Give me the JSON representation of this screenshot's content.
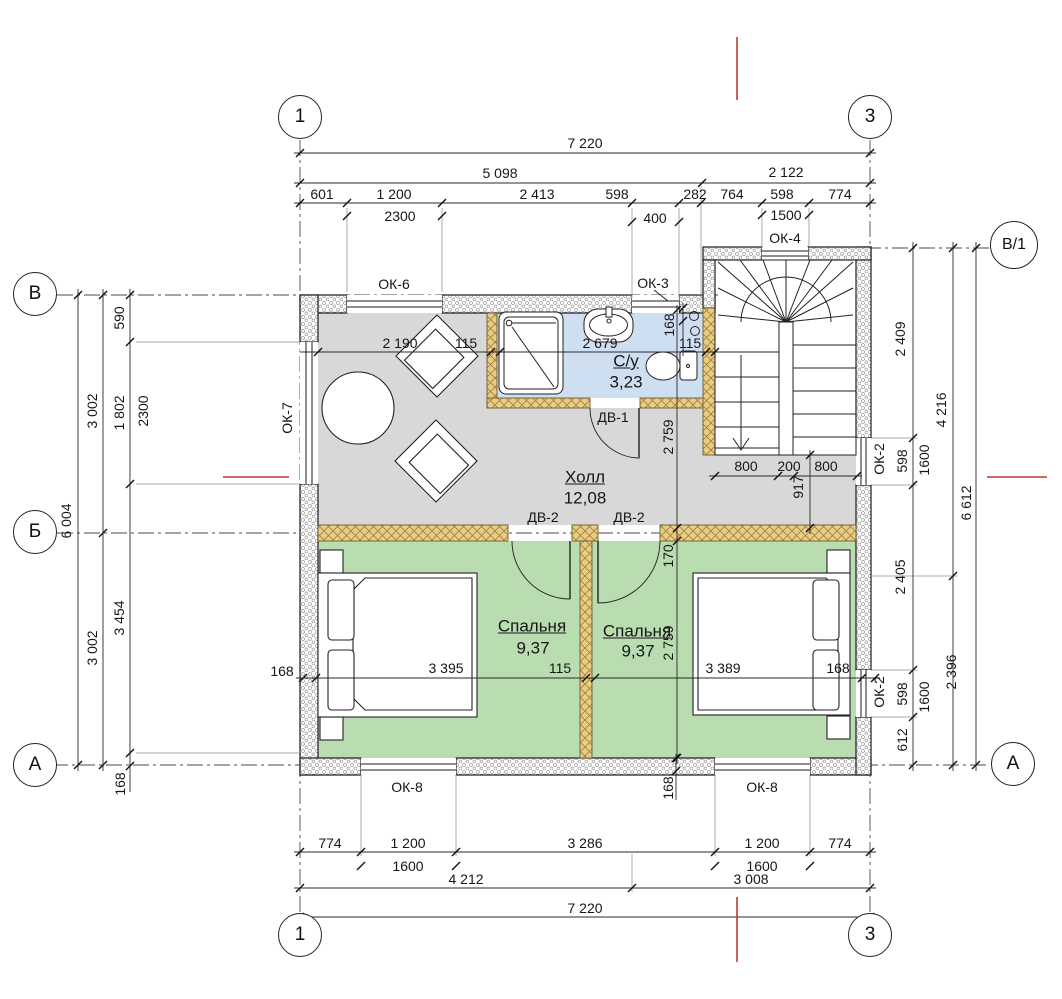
{
  "meta": {
    "type": "floor-plan",
    "language": "ru",
    "units": "mm"
  },
  "rooms": [
    {
      "name": "Холл",
      "area": "12,08"
    },
    {
      "name": "С/у",
      "area": "3,23"
    },
    {
      "name": "Спальня",
      "area": "9,37"
    },
    {
      "name": "Спальня",
      "area": "9,37"
    }
  ],
  "windows": [
    "ОК-2",
    "ОК-3",
    "ОК-4",
    "ОК-6",
    "ОК-7",
    "ОК-8"
  ],
  "doors": [
    "ДВ-1",
    "ДВ-2"
  ],
  "colors": {
    "hall": "#d8d8d8",
    "bath": "#cfdff2",
    "bedroom": "#b9dcb1",
    "partition": "#e7cd85",
    "partition_hatch": "#a5803a",
    "red_mark": "#c0392b"
  },
  "axes": {
    "columns": [
      "1",
      "3"
    ],
    "rows": [
      "В",
      "Б",
      "А",
      "В/1"
    ]
  },
  "axis_circles": [
    {
      "n": "axis-col-1-top",
      "t": "1",
      "x": 300,
      "y": 117,
      "d": 44
    },
    {
      "n": "axis-col-3-top",
      "t": "3",
      "x": 870,
      "y": 117,
      "d": 44
    },
    {
      "n": "axis-col-1-bottom",
      "t": "1",
      "x": 300,
      "y": 935,
      "d": 44
    },
    {
      "n": "axis-col-3-bottom",
      "t": "3",
      "x": 870,
      "y": 935,
      "d": 44
    },
    {
      "n": "axis-row-v",
      "t": "В",
      "x": 35,
      "y": 294,
      "d": 44
    },
    {
      "n": "axis-row-b",
      "t": "Б",
      "x": 35,
      "y": 532,
      "d": 44
    },
    {
      "n": "axis-row-a-left",
      "t": "А",
      "x": 35,
      "y": 765,
      "d": 44
    },
    {
      "n": "axis-row-v1",
      "t": "В/1",
      "x": 1014,
      "y": 245,
      "d": 48,
      "size": 16
    },
    {
      "n": "axis-row-a-right",
      "t": "А",
      "x": 1013,
      "y": 764,
      "d": 44
    }
  ],
  "labels": [
    {
      "n": "dim-top-7220",
      "text": "7 220",
      "x": 585,
      "y": 143
    },
    {
      "n": "dim-top-5098",
      "text": "5 098",
      "x": 500,
      "y": 173
    },
    {
      "n": "dim-top-2122",
      "text": "2 122",
      "x": 786,
      "y": 172
    },
    {
      "n": "dim-top-601",
      "text": "601",
      "x": 322,
      "y": 194
    },
    {
      "n": "dim-top-1200",
      "text": "1 200",
      "x": 394,
      "y": 194
    },
    {
      "n": "dim-top-2413",
      "text": "2 413",
      "x": 537,
      "y": 194
    },
    {
      "n": "dim-top-598a",
      "text": "598",
      "x": 617,
      "y": 194
    },
    {
      "n": "dim-top-282",
      "text": "282",
      "x": 695,
      "y": 194
    },
    {
      "n": "dim-top-764",
      "text": "764",
      "x": 732,
      "y": 194
    },
    {
      "n": "dim-top-598b",
      "text": "598",
      "x": 782,
      "y": 194
    },
    {
      "n": "dim-top-774",
      "text": "774",
      "x": 840,
      "y": 194
    },
    {
      "n": "dim-top-2300",
      "text": "2300",
      "x": 400,
      "y": 216
    },
    {
      "n": "dim-top-400",
      "text": "400",
      "x": 655,
      "y": 218
    },
    {
      "n": "dim-top-1500",
      "text": "1500",
      "x": 786,
      "y": 215
    },
    {
      "n": "dim-bottom-774a",
      "text": "774",
      "x": 330,
      "y": 843
    },
    {
      "n": "dim-bottom-1200a",
      "text": "1 200",
      "x": 408,
      "y": 843
    },
    {
      "n": "dim-bottom-3286",
      "text": "3 286",
      "x": 585,
      "y": 843
    },
    {
      "n": "dim-bottom-1200b",
      "text": "1 200",
      "x": 762,
      "y": 843
    },
    {
      "n": "dim-bottom-774b",
      "text": "774",
      "x": 840,
      "y": 843
    },
    {
      "n": "dim-bottom-1600a",
      "text": "1600",
      "x": 408,
      "y": 866
    },
    {
      "n": "dim-bottom-1600b",
      "text": "1600",
      "x": 762,
      "y": 866
    },
    {
      "n": "dim-bottom-4212",
      "text": "4 212",
      "x": 466,
      "y": 879
    },
    {
      "n": "dim-bottom-3008",
      "text": "3 008",
      "x": 751,
      "y": 879
    },
    {
      "n": "dim-bottom-7220",
      "text": "7 220",
      "x": 585,
      "y": 908
    },
    {
      "n": "dim-left-590",
      "text": "590",
      "x": 119,
      "y": 318,
      "rot": -90
    },
    {
      "n": "dim-left-1802",
      "text": "1 802",
      "x": 119,
      "y": 413,
      "rot": -90
    },
    {
      "n": "dim-left-2300",
      "text": "2300",
      "x": 143,
      "y": 411,
      "rot": -90
    },
    {
      "n": "dim-left-3002a",
      "text": "3 002",
      "x": 92,
      "y": 411,
      "rot": -90
    },
    {
      "n": "dim-left-6004",
      "text": "6 004",
      "x": 66,
      "y": 521,
      "rot": -90
    },
    {
      "n": "dim-left-3454",
      "text": "3 454",
      "x": 119,
      "y": 618,
      "rot": -90
    },
    {
      "n": "dim-left-3002b",
      "text": "3 002",
      "x": 92,
      "y": 648,
      "rot": -90
    },
    {
      "n": "dim-left-168",
      "text": "168",
      "x": 120,
      "y": 784,
      "rot": -90
    },
    {
      "n": "dim-right-2409",
      "text": "2 409",
      "x": 900,
      "y": 339,
      "rot": -90
    },
    {
      "n": "dim-right-598a",
      "text": "598",
      "x": 902,
      "y": 461,
      "rot": -90
    },
    {
      "n": "dim-right-1600a",
      "text": "1600",
      "x": 924,
      "y": 460,
      "rot": -90
    },
    {
      "n": "dim-right-2405",
      "text": "2 405",
      "x": 900,
      "y": 577,
      "rot": -90
    },
    {
      "n": "dim-right-598b",
      "text": "598",
      "x": 902,
      "y": 694,
      "rot": -90
    },
    {
      "n": "dim-right-1600b",
      "text": "1600",
      "x": 924,
      "y": 697,
      "rot": -90
    },
    {
      "n": "dim-right-612",
      "text": "612",
      "x": 902,
      "y": 740,
      "rot": -90
    },
    {
      "n": "dim-right-4216",
      "text": "4 216",
      "x": 941,
      "y": 410,
      "rot": -90
    },
    {
      "n": "dim-right-2396",
      "text": "2 396",
      "x": 951,
      "y": 672,
      "rot": -90
    },
    {
      "n": "dim-right-6612",
      "text": "6 612",
      "x": 966,
      "y": 503,
      "rot": -90
    },
    {
      "n": "window-tag-ok2-stair",
      "text": "ОК-2",
      "x": 879,
      "y": 459,
      "rot": -90
    },
    {
      "n": "window-tag-ok2-bedroom",
      "text": "ОК-2",
      "x": 879,
      "y": 692,
      "rot": -90
    },
    {
      "n": "window-tag-ok6",
      "text": "ОК-6",
      "x": 394,
      "y": 284
    },
    {
      "n": "window-tag-ok3",
      "text": "ОК-3",
      "x": 653,
      "y": 283
    },
    {
      "n": "window-tag-ok4",
      "text": "ОК-4",
      "x": 785,
      "y": 238
    },
    {
      "n": "window-tag-ok7",
      "text": "ОК-7",
      "x": 287,
      "y": 418,
      "rot": -90
    },
    {
      "n": "window-tag-ok8-left",
      "text": "ОК-8",
      "x": 407,
      "y": 787
    },
    {
      "n": "window-tag-ok8-right",
      "text": "ОК-8",
      "x": 762,
      "y": 787
    },
    {
      "n": "door-tag-dv1",
      "text": "ДВ-1",
      "x": 613,
      "y": 417
    },
    {
      "n": "door-tag-dv2-left",
      "text": "ДВ-2",
      "x": 543,
      "y": 517
    },
    {
      "n": "door-tag-dv2-right",
      "text": "ДВ-2",
      "x": 629,
      "y": 517
    },
    {
      "n": "dim-int-2190",
      "text": "2 190",
      "x": 400,
      "y": 343
    },
    {
      "n": "dim-int-115a",
      "text": "115",
      "x": 466,
      "y": 343
    },
    {
      "n": "dim-int-2679",
      "text": "2 679",
      "x": 600,
      "y": 343
    },
    {
      "n": "dim-int-115b",
      "text": "115",
      "x": 690,
      "y": 343
    },
    {
      "n": "dim-int-168a",
      "text": "168",
      "x": 669,
      "y": 325,
      "rot": -90
    },
    {
      "n": "dim-int-2759-hall",
      "text": "2 759",
      "x": 668,
      "y": 437,
      "rot": -90
    },
    {
      "n": "dim-int-170",
      "text": "170",
      "x": 668,
      "y": 556,
      "rot": -90
    },
    {
      "n": "dim-int-2759-bedroom",
      "text": "2 759",
      "x": 668,
      "y": 643,
      "rot": -90
    },
    {
      "n": "dim-int-800a",
      "text": "800",
      "x": 746,
      "y": 466
    },
    {
      "n": "dim-int-200",
      "text": "200",
      "x": 789,
      "y": 466
    },
    {
      "n": "dim-int-800b",
      "text": "800",
      "x": 826,
      "y": 466
    },
    {
      "n": "dim-int-917",
      "text": "917",
      "x": 798,
      "y": 487,
      "rot": -90
    },
    {
      "n": "dim-int-168-left",
      "text": "168",
      "x": 282,
      "y": 671
    },
    {
      "n": "dim-int-3395",
      "text": "3 395",
      "x": 446,
      "y": 668
    },
    {
      "n": "dim-int-115c",
      "text": "115",
      "x": 560,
      "y": 668
    },
    {
      "n": "dim-int-3389",
      "text": "3 389",
      "x": 723,
      "y": 668
    },
    {
      "n": "dim-int-168-right",
      "text": "168",
      "x": 838,
      "y": 668
    },
    {
      "n": "dim-int-168-bottom",
      "text": "168",
      "x": 668,
      "y": 788,
      "rot": -90
    },
    {
      "n": "room-name-hall",
      "text": "Холл",
      "x": 585,
      "y": 477,
      "size": 17,
      "u": true
    },
    {
      "n": "room-area-hall",
      "text": "12,08",
      "x": 585,
      "y": 498,
      "size": 17
    },
    {
      "n": "room-name-bath",
      "text": "С/у",
      "x": 626,
      "y": 361,
      "size": 17,
      "u": true
    },
    {
      "n": "room-area-bath",
      "text": "3,23",
      "x": 626,
      "y": 382,
      "size": 17
    },
    {
      "n": "room-name-bedroom-1",
      "text": "Спальня",
      "x": 532,
      "y": 626,
      "size": 17,
      "u": true
    },
    {
      "n": "room-area-bedroom-1",
      "text": "9,37",
      "x": 533,
      "y": 648,
      "size": 17
    },
    {
      "n": "room-name-bedroom-2",
      "text": "Спальня",
      "x": 637,
      "y": 631,
      "size": 17,
      "u": true
    },
    {
      "n": "room-area-bedroom-2",
      "text": "9,37",
      "x": 638,
      "y": 651,
      "size": 17
    }
  ],
  "dim_chains": [
    {
      "o": "h",
      "p": 153,
      "a": 294,
      "b": 876,
      "t": [
        300,
        870
      ]
    },
    {
      "o": "h",
      "p": 183,
      "a": 294,
      "b": 876,
      "t": [
        300,
        702,
        870
      ]
    },
    {
      "o": "h",
      "p": 203,
      "a": 294,
      "b": 876,
      "t": [
        300,
        347,
        442,
        632,
        679,
        701,
        762,
        809,
        870
      ]
    },
    {
      "o": "h",
      "p": 216,
      "a": 347,
      "b": 442,
      "t": [
        347,
        442
      ],
      "noline": true
    },
    {
      "o": "h",
      "p": 222,
      "a": 632,
      "b": 679,
      "t": [
        632,
        679
      ],
      "noline": true
    },
    {
      "o": "h",
      "p": 215,
      "a": 762,
      "b": 809,
      "t": [
        762,
        809
      ],
      "noline": true
    },
    {
      "o": "h",
      "p": 852,
      "a": 294,
      "b": 876,
      "t": [
        300,
        361,
        456,
        715,
        810,
        870
      ]
    },
    {
      "o": "h",
      "p": 866,
      "a": 361,
      "b": 456,
      "t": [
        361,
        456
      ],
      "noline": true
    },
    {
      "o": "h",
      "p": 866,
      "a": 715,
      "b": 810,
      "t": [
        715,
        810
      ],
      "noline": true
    },
    {
      "o": "h",
      "p": 888,
      "a": 294,
      "b": 876,
      "t": [
        300,
        632,
        870
      ]
    },
    {
      "o": "h",
      "p": 917,
      "a": 294,
      "b": 876,
      "t": [
        300,
        870
      ]
    },
    {
      "o": "h",
      "p": 352,
      "a": 300,
      "b": 722,
      "t": [
        318,
        491,
        500,
        706,
        715
      ]
    },
    {
      "o": "h",
      "p": 678,
      "a": 296,
      "b": 880,
      "t": [
        303,
        316,
        586,
        595,
        862,
        875
      ]
    },
    {
      "o": "h",
      "p": 476,
      "a": 709,
      "b": 862,
      "t": [
        715,
        778,
        794,
        857
      ]
    },
    {
      "o": "v",
      "p": 78,
      "a": 289,
      "b": 771,
      "t": [
        295,
        765
      ]
    },
    {
      "o": "v",
      "p": 103,
      "a": 289,
      "b": 771,
      "t": [
        295,
        533,
        765
      ]
    },
    {
      "o": "v",
      "p": 130,
      "a": 289,
      "b": 792,
      "t": [
        295,
        342,
        484,
        753,
        766
      ]
    },
    {
      "o": "v",
      "p": 913,
      "a": 242,
      "b": 771,
      "t": [
        248,
        438,
        485,
        670,
        717,
        765
      ]
    },
    {
      "o": "v",
      "p": 953,
      "a": 242,
      "b": 771,
      "t": [
        248,
        576,
        765
      ]
    },
    {
      "o": "v",
      "p": 976,
      "a": 242,
      "b": 771,
      "t": [
        248,
        765
      ]
    },
    {
      "o": "v",
      "p": 677,
      "a": 305,
      "b": 764,
      "t": [
        310,
        528,
        541,
        758
      ]
    },
    {
      "o": "v",
      "p": 810,
      "a": 450,
      "b": 534,
      "t": [
        455,
        528
      ]
    },
    {
      "o": "v",
      "p": 683,
      "a": 303,
      "b": 356,
      "t": [
        308,
        321
      ]
    },
    {
      "o": "v",
      "p": 676,
      "a": 754,
      "b": 800,
      "t": [
        758,
        771
      ]
    }
  ],
  "ext_lines": [
    {
      "o": "v",
      "p": 347,
      "a": 208,
      "b": 292
    },
    {
      "o": "v",
      "p": 442,
      "a": 208,
      "b": 292
    },
    {
      "o": "v",
      "p": 632,
      "a": 208,
      "b": 298
    },
    {
      "o": "v",
      "p": 679,
      "a": 208,
      "b": 298
    },
    {
      "o": "v",
      "p": 701,
      "a": 186,
      "b": 300
    },
    {
      "o": "v",
      "p": 762,
      "a": 208,
      "b": 246
    },
    {
      "o": "v",
      "p": 809,
      "a": 208,
      "b": 246
    },
    {
      "o": "v",
      "p": 361,
      "a": 775,
      "b": 856
    },
    {
      "o": "v",
      "p": 456,
      "a": 775,
      "b": 856
    },
    {
      "o": "v",
      "p": 715,
      "a": 775,
      "b": 856
    },
    {
      "o": "v",
      "p": 810,
      "a": 775,
      "b": 856
    },
    {
      "o": "v",
      "p": 632,
      "a": 854,
      "b": 892
    },
    {
      "o": "h",
      "p": 342,
      "a": 136,
      "b": 300
    },
    {
      "o": "h",
      "p": 484,
      "a": 136,
      "b": 300
    },
    {
      "o": "h",
      "p": 753,
      "a": 136,
      "b": 300
    },
    {
      "o": "h",
      "p": 438,
      "a": 872,
      "b": 917
    },
    {
      "o": "h",
      "p": 485,
      "a": 872,
      "b": 917
    },
    {
      "o": "h",
      "p": 670,
      "a": 872,
      "b": 917
    },
    {
      "o": "h",
      "p": 717,
      "a": 872,
      "b": 917
    },
    {
      "o": "h",
      "p": 576,
      "a": 872,
      "b": 957
    }
  ],
  "axis_lines": [
    {
      "o": "v",
      "p": 300,
      "a": 140,
      "b": 912
    },
    {
      "o": "v",
      "p": 870,
      "a": 140,
      "b": 912
    },
    {
      "o": "h",
      "p": 295,
      "a": 57,
      "b": 718
    },
    {
      "o": "h",
      "p": 533,
      "a": 57,
      "b": 868
    },
    {
      "o": "h",
      "p": 765,
      "a": 52,
      "b": 990
    },
    {
      "o": "h",
      "p": 248,
      "a": 703,
      "b": 989
    }
  ],
  "red_marks": [
    {
      "x1": 737,
      "y1": 37,
      "x2": 737,
      "y2": 100
    },
    {
      "x1": 223,
      "y1": 477,
      "x2": 289,
      "y2": 477
    },
    {
      "x1": 987,
      "y1": 477,
      "x2": 1047,
      "y2": 477
    },
    {
      "x1": 737,
      "y1": 897,
      "x2": 737,
      "y2": 962
    }
  ]
}
